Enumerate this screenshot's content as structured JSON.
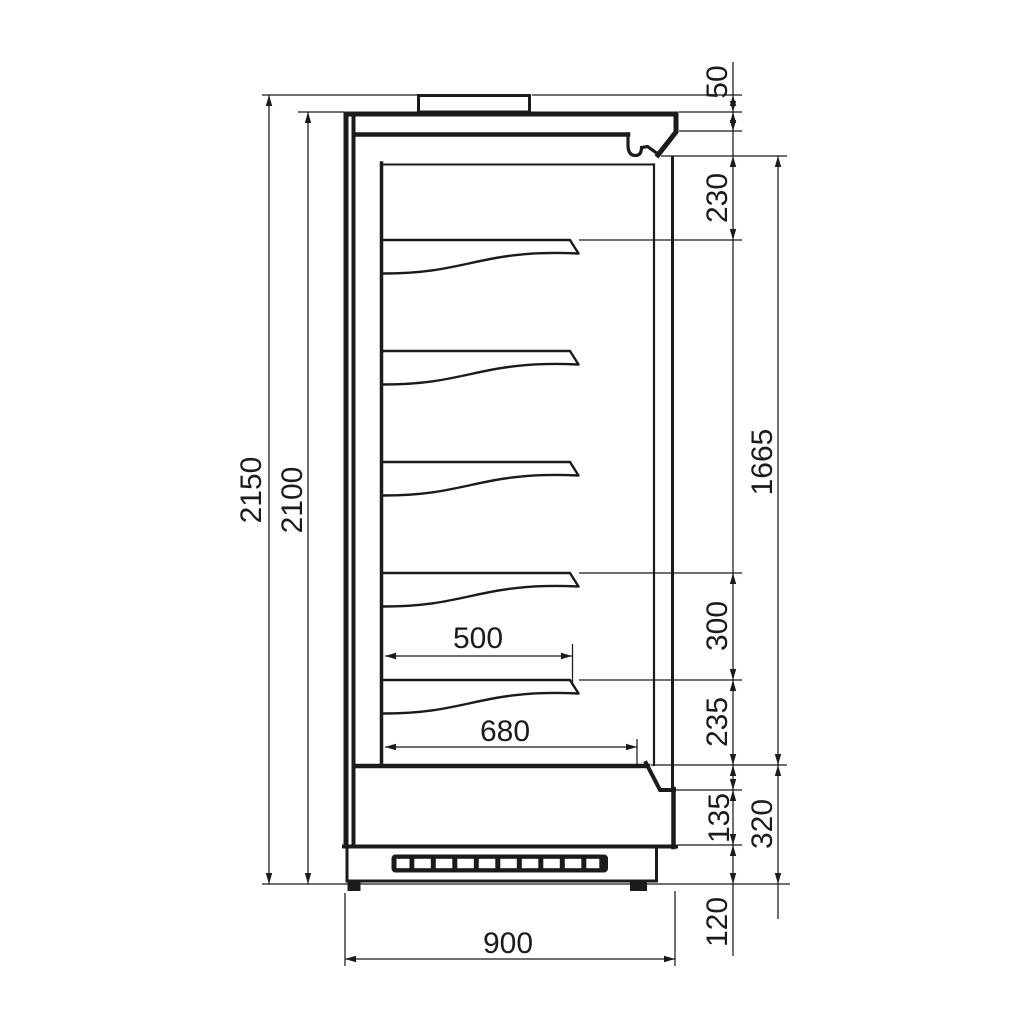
{
  "drawing": {
    "colors": {
      "line": "#1b1b1b",
      "background": "#ffffff"
    },
    "shelf_count": 5,
    "dimensions": {
      "overall_height": "2150",
      "body_height": "2100",
      "top_spigot_height": "50",
      "canopy_to_top_shelf": "230",
      "display_opening_height": "1665",
      "lower_shelf_spacing": "300",
      "bottom_shelf_to_deck": "235",
      "front_lower_panel_height": "135",
      "deck_height": "320",
      "plinth_height": "120",
      "shelf_depth": "500",
      "internal_depth": "680",
      "overall_depth": "900"
    }
  }
}
